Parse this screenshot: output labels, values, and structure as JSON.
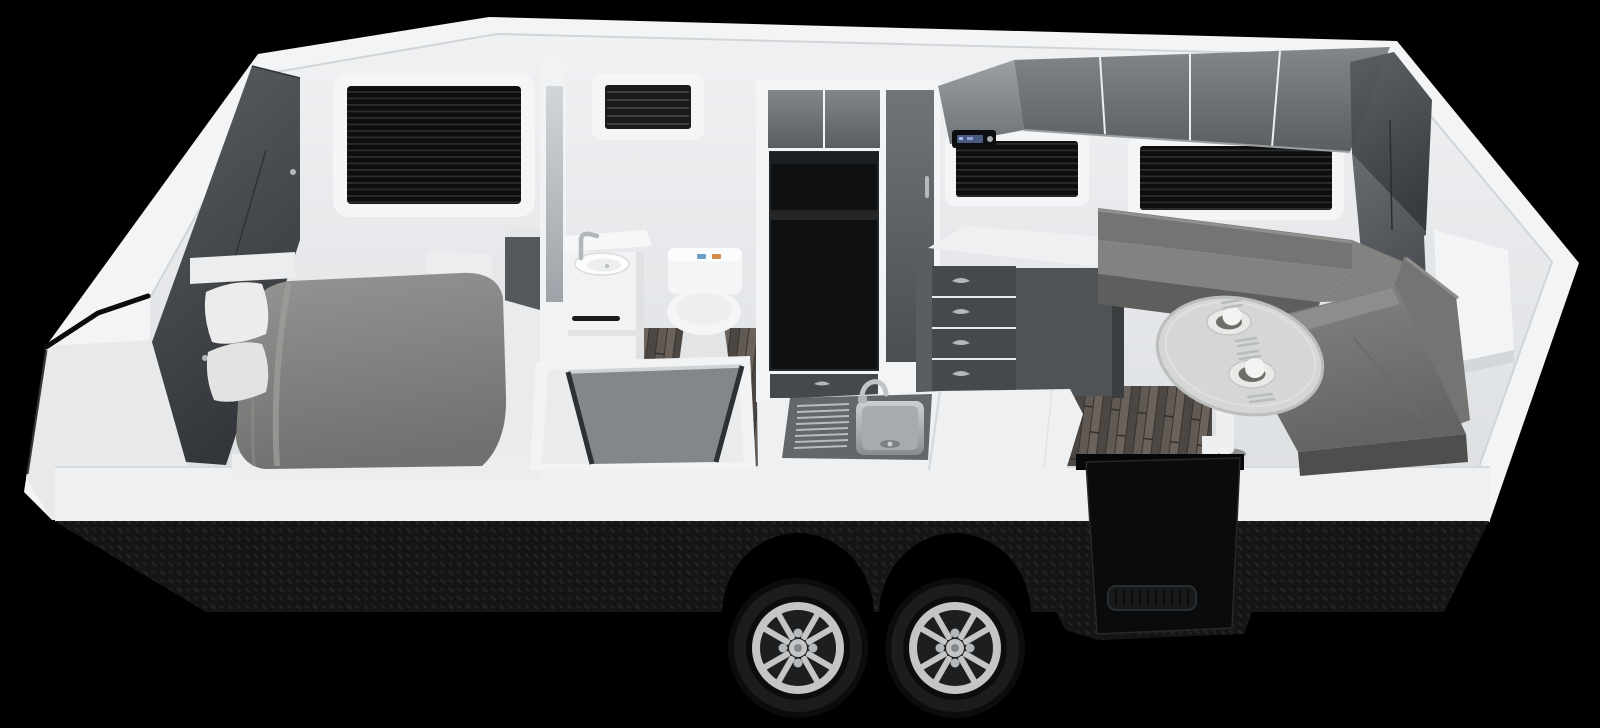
{
  "scene": {
    "type": "3d-render",
    "subject": "caravan interior cutaway floorplan",
    "view": "elevated front-side cutaway, nose at left, tandem axles below",
    "background": "#000000"
  },
  "colors": {
    "bg": "#000000",
    "body": "#f2f4f5",
    "wedge": "#e7e9eb",
    "nearband": "#eef0f2",
    "trim": "#0b0b0b",
    "casing": "#f3f4f6",
    "fridge_black": "#0f1012",
    "fridge_shelf": "#232527",
    "drawer": "#46494c",
    "cupboard": "#505356",
    "side_panel": "#3b3e41",
    "handle": "#b5b9bc",
    "bench_white": "#eff0f2",
    "bench_shade": "#d8dbdd",
    "sink_surround": "#63676a",
    "window_frame": "#f3f5f6",
    "partition": "#f0f2f3",
    "vanity": "#f1f2f4",
    "toilet": "#f4f5f6",
    "toilet_shade": "#e2e4e6",
    "button_blue": "#6aa0c8",
    "button_orange": "#d08a4a",
    "towel_rail": "#1a1b1d",
    "shower_glass": "#7b7f83",
    "seat_back": "#747472",
    "seat_top": "#828280",
    "seat_side": "#5e5e5c",
    "seat_bolster": "#8d8d8b",
    "seat_shadow": "#4e4e4c",
    "table_top": "#d5d7d6",
    "table_edge": "#bcbebd",
    "plate": "#e9e9e7",
    "plate_ring": "#6e6e67",
    "dome": "#f3f3f1",
    "pedestal": "#edeff0",
    "step_panel": "#0a0b0c",
    "grille": "#17191a",
    "radio_body": "#0d0e10",
    "radio_display": "#4a5a82",
    "box_white": "#f3f4f6",
    "tire": "#0c0c0c",
    "rim": "#c3c5c7",
    "rim_dark": "#2b2d2e",
    "bed_base": "#ebedee",
    "pillow": "#ececec",
    "wood_plank": "#5a544f",
    "skirt_base": "#151515",
    "cabinet_gloss": "#7f8488",
    "glass_dark": "#44484c"
  },
  "objects": {
    "front_wardrobe": "mirrored gloss wardrobe on angled nose",
    "bed": "double bed with grey duvet",
    "pillows": "white pillows",
    "bedroom_window": "window with black blind",
    "bedside_cabinet": "grey bedside cabinet",
    "mirror": "full-height mirror on partition",
    "vanity": "white washbasin vanity with tap and towel rail",
    "toilet": "white toilet with flush buttons",
    "shower": "shower cubicle with smoked glass screen",
    "vent_window": "louvred vent window",
    "fridge": "black fridge recess in tall cabinet",
    "pantry": "gloss pantry door",
    "kitchen_bench": "bench with stainless sink and drainer",
    "drawers": "four-drawer stack with cup handles",
    "cupboard": "base cupboard",
    "overhead_cabinets": "gloss overhead lockers",
    "stereo": "stereo head unit with blue display",
    "kitchen_window": "window with black blind",
    "dinette_window": "wide window with black blind",
    "dinette": "L-shaped grey leather dinette lounge",
    "table": "oval table with two place settings and cutlery",
    "rear_box": "white rear corner box",
    "entry_step": "black entry step panel with grille",
    "wheels": "tandem black tyres with silver alloy rims",
    "skirt": "black checkerplate lower skirt",
    "floor": "grey timber-look plank floor"
  }
}
